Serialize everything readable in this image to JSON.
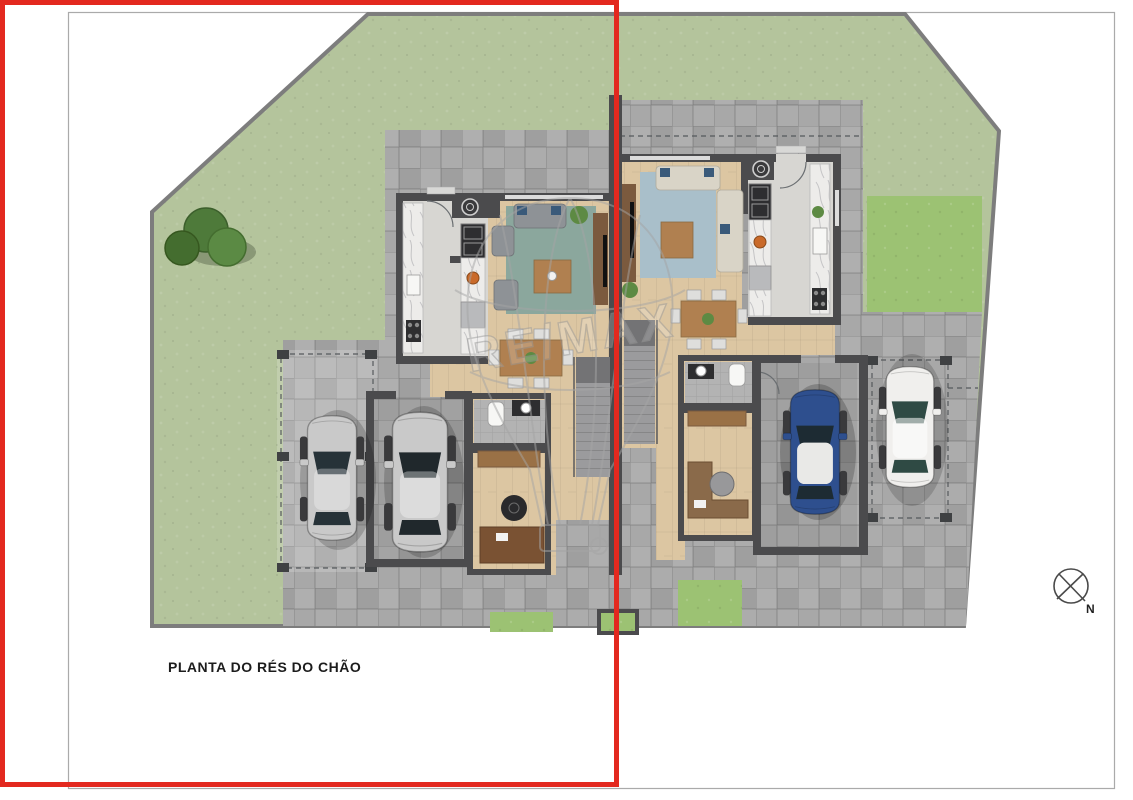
{
  "title": {
    "label": "PLANTA DO RÉS DO CHÃO"
  },
  "compass": {
    "label": "N"
  },
  "watermark": {
    "brand": "RE/MAX"
  },
  "colors": {
    "overlay_red": "#e3291f",
    "page_border": "#aaaaaa",
    "fence": "#7d7d7d",
    "lawn": "#b4c49c",
    "lawn_bright": "#9cc273",
    "paving": "#a8a8a8",
    "wall": "#4b4b4d",
    "wood": "#dcc6a2",
    "wood_dark": "#7b5a3e",
    "kitchen_floor": "#d7d6d2",
    "marble": "#edecea",
    "steel": "#b9babc",
    "appliance": "#2e2e30",
    "rug_left": "#8ba79d",
    "rug_right": "#a9bfca",
    "sofa_gray": "#8e9296",
    "sofa_cream": "#d9d4c7",
    "cushion_blue": "#3a5a7a",
    "table_wood": "#b08050",
    "stair": "#9b9b9d",
    "stair_dark": "#737375",
    "tile_wc": "#b3b3b3",
    "car_silver": "#c9c9c9",
    "car_blue": "#2e4f8e",
    "car_white": "#f0efed",
    "glass_dark": "#263238",
    "tree_green": "#4e7a3a",
    "plant_green": "#5d8a43",
    "watermark_gray": "#a5a5a5",
    "text_dark": "#1c1c1c"
  }
}
